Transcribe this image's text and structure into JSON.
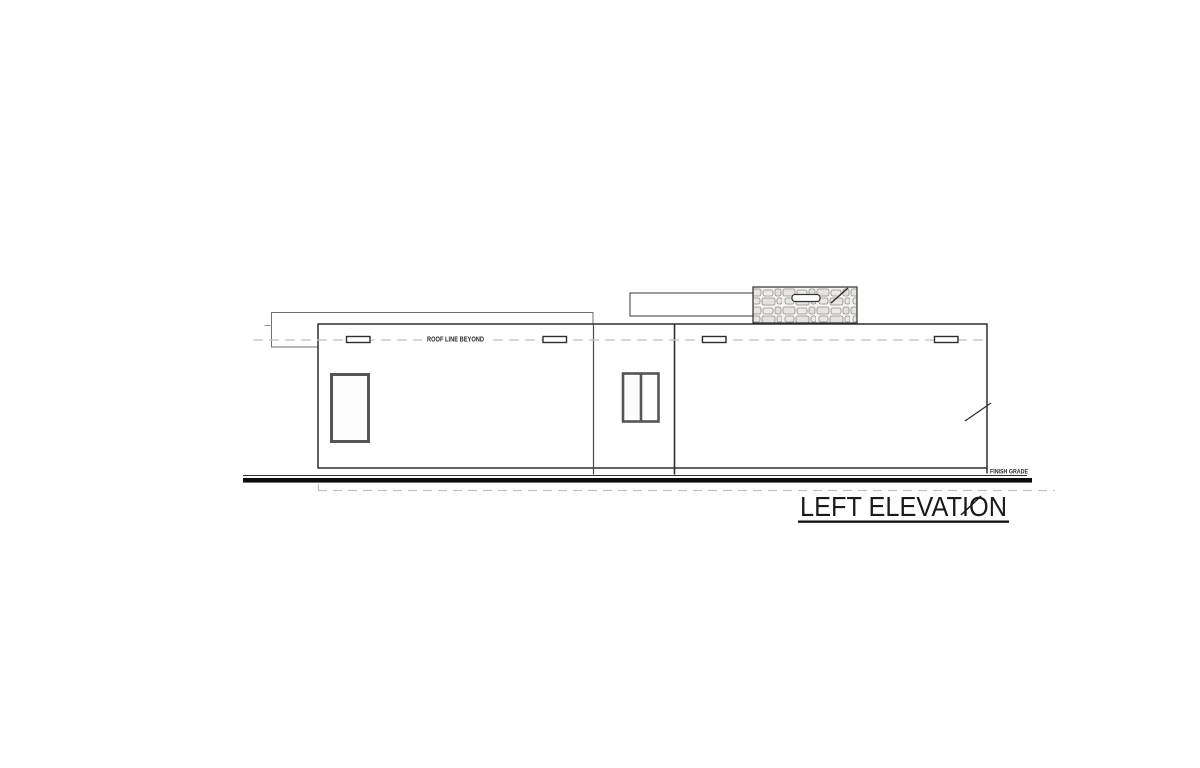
{
  "drawing": {
    "title": "LEFT ELEVATION",
    "labels": {
      "roof_line_beyond": "ROOF LINE BEYOND",
      "finish_grade": "FINISH GRADE"
    },
    "colors": {
      "paper": "#ffffff",
      "line_dark": "#2e2e2e",
      "line_medium": "#4a4a4a",
      "line_light": "#6f6f6f",
      "window_frame": "#555555",
      "dash_gray": "#c2c2c2",
      "grade_black": "#0d0d0d",
      "stone_fill": "#e6e4e0",
      "stone_joint": "#8f8f8f"
    }
  }
}
